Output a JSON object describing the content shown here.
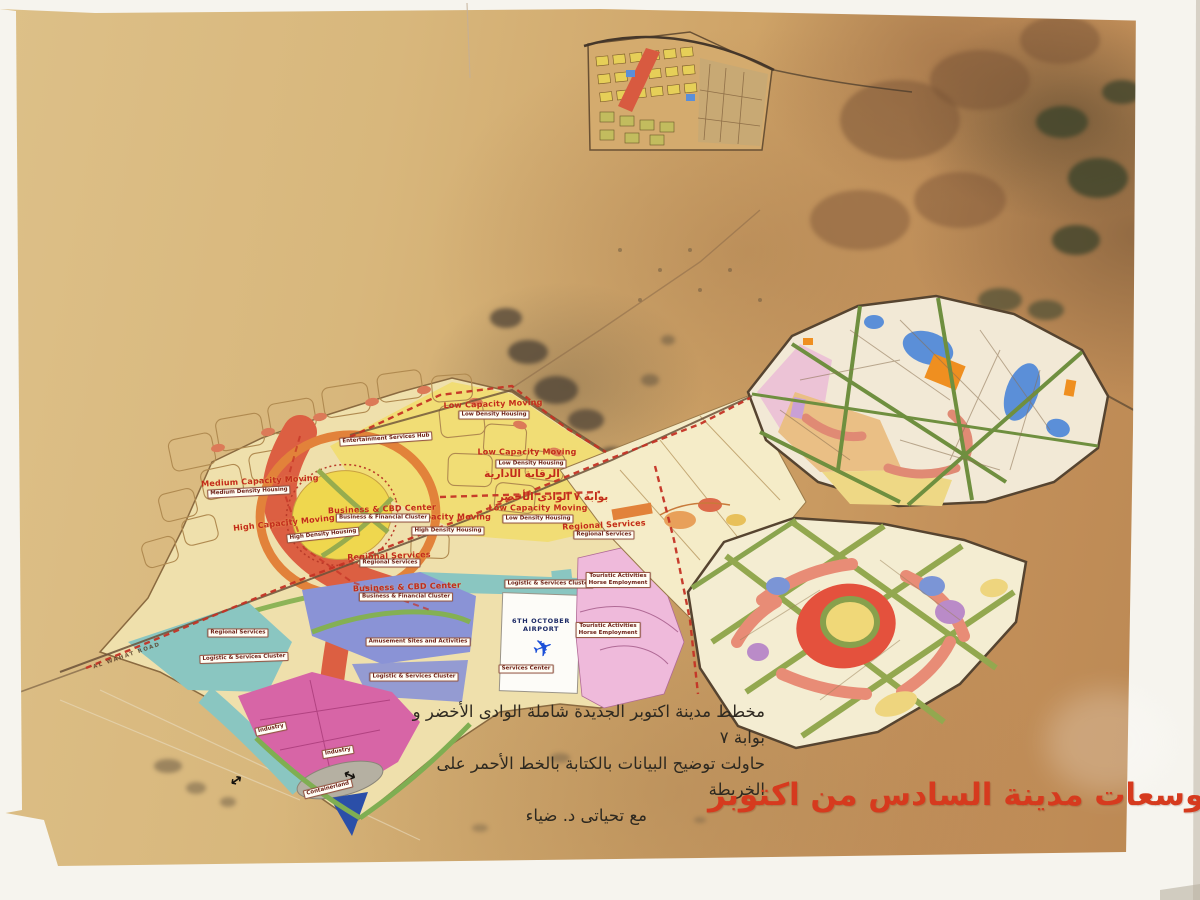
{
  "title": {
    "text": "توسعات مدينة السادس من اكتوبر"
  },
  "note": {
    "line1": "مخطط مدينة اكتوبر الجديدة شاملة الوادى الأخضر و بوابة ٧",
    "line2": "حاولت توضيح البيانات  بالكتابة بالخط الأحمر على الخريطة",
    "line3": "مع تحياتى د. ضياء"
  },
  "marker_labels": {
    "low_capacity": "Low Capacity Moving",
    "medium_capacity": "Medium Capacity Moving",
    "high_capacity": "High Capacity Moving",
    "regional_services": "Regional Services",
    "business_center": "Business & CBD Center",
    "admin_control_ar": "الرقابة الأدارية",
    "green_valley_gate_ar": "بوابة ٧ الوادى الأخضر"
  },
  "zone_chips": {
    "low_density": "Low Density Housing",
    "medium_density": "Medium Density Housing",
    "high_density": "High Density Housing",
    "business_financial": "Business & Financial Cluster",
    "regional_services": "Regional Services",
    "entertainment_hub": "Entertainment Services Hub",
    "logistic_cluster": "Logistic & Services Cluster",
    "amusement": "Amusement Sites and Activities",
    "touristic_line1": "Touristic Activities",
    "touristic_line2": "Horse Employment",
    "industry": "Industry",
    "containerland": "Containerland",
    "services_center": "Services Center"
  },
  "airport": {
    "name_line1": "6TH OCTOBER",
    "name_line2": "AIRPORT",
    "plane_glyph": "✈"
  },
  "roads": {
    "al_wahat": "AL WAHAT ROAD"
  },
  "symbols": {
    "double_arrow": "↔"
  },
  "colors": {
    "annotation_red": "#c43325",
    "title_red": "#d63a1e",
    "high_density_red": "#dc5f42",
    "medium_density_yellow": "#efd74e",
    "ring_orange": "#e2823a",
    "logistics_teal": "#8ac6c1",
    "amusement_blue": "#8a93d6",
    "industry_magenta": "#d765a6",
    "touristic_pink": "#efbadb",
    "green_boulevard": "#93a84f",
    "desert_tan": "#d3ac6e"
  }
}
